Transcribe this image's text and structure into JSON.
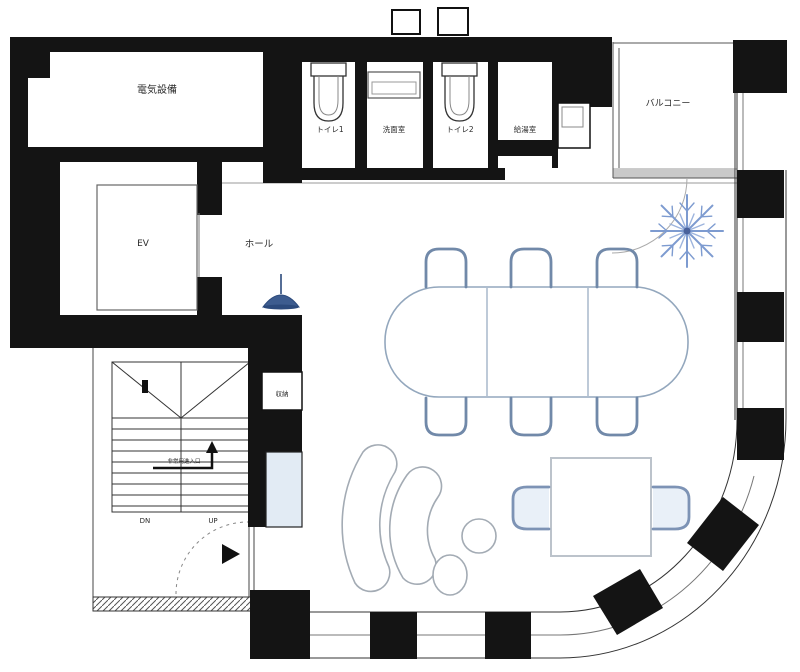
{
  "plan": {
    "rooms": {
      "electrical": "電気設備",
      "toilet1": "トイレ1",
      "washroom": "洗面室",
      "toilet2": "トイレ2",
      "kitchenette": "給湯室",
      "balcony": "バルコニー",
      "elevator": "EV",
      "hall": "ホール",
      "storage": "収納"
    },
    "stairs": {
      "down_label": "DN",
      "up_label": "UP",
      "note": "非常用進入口"
    },
    "colors": {
      "wall": "#141414",
      "thin_line": "#555555",
      "chair_outline": "#7189a9",
      "sofa_outline": "#a3abb4",
      "plant_blue": "#7d9bd0",
      "pendant_blue": "#3d5c8f",
      "counter_fill": "#e2ebf4",
      "chair_fill": "#e9f0f8"
    }
  }
}
